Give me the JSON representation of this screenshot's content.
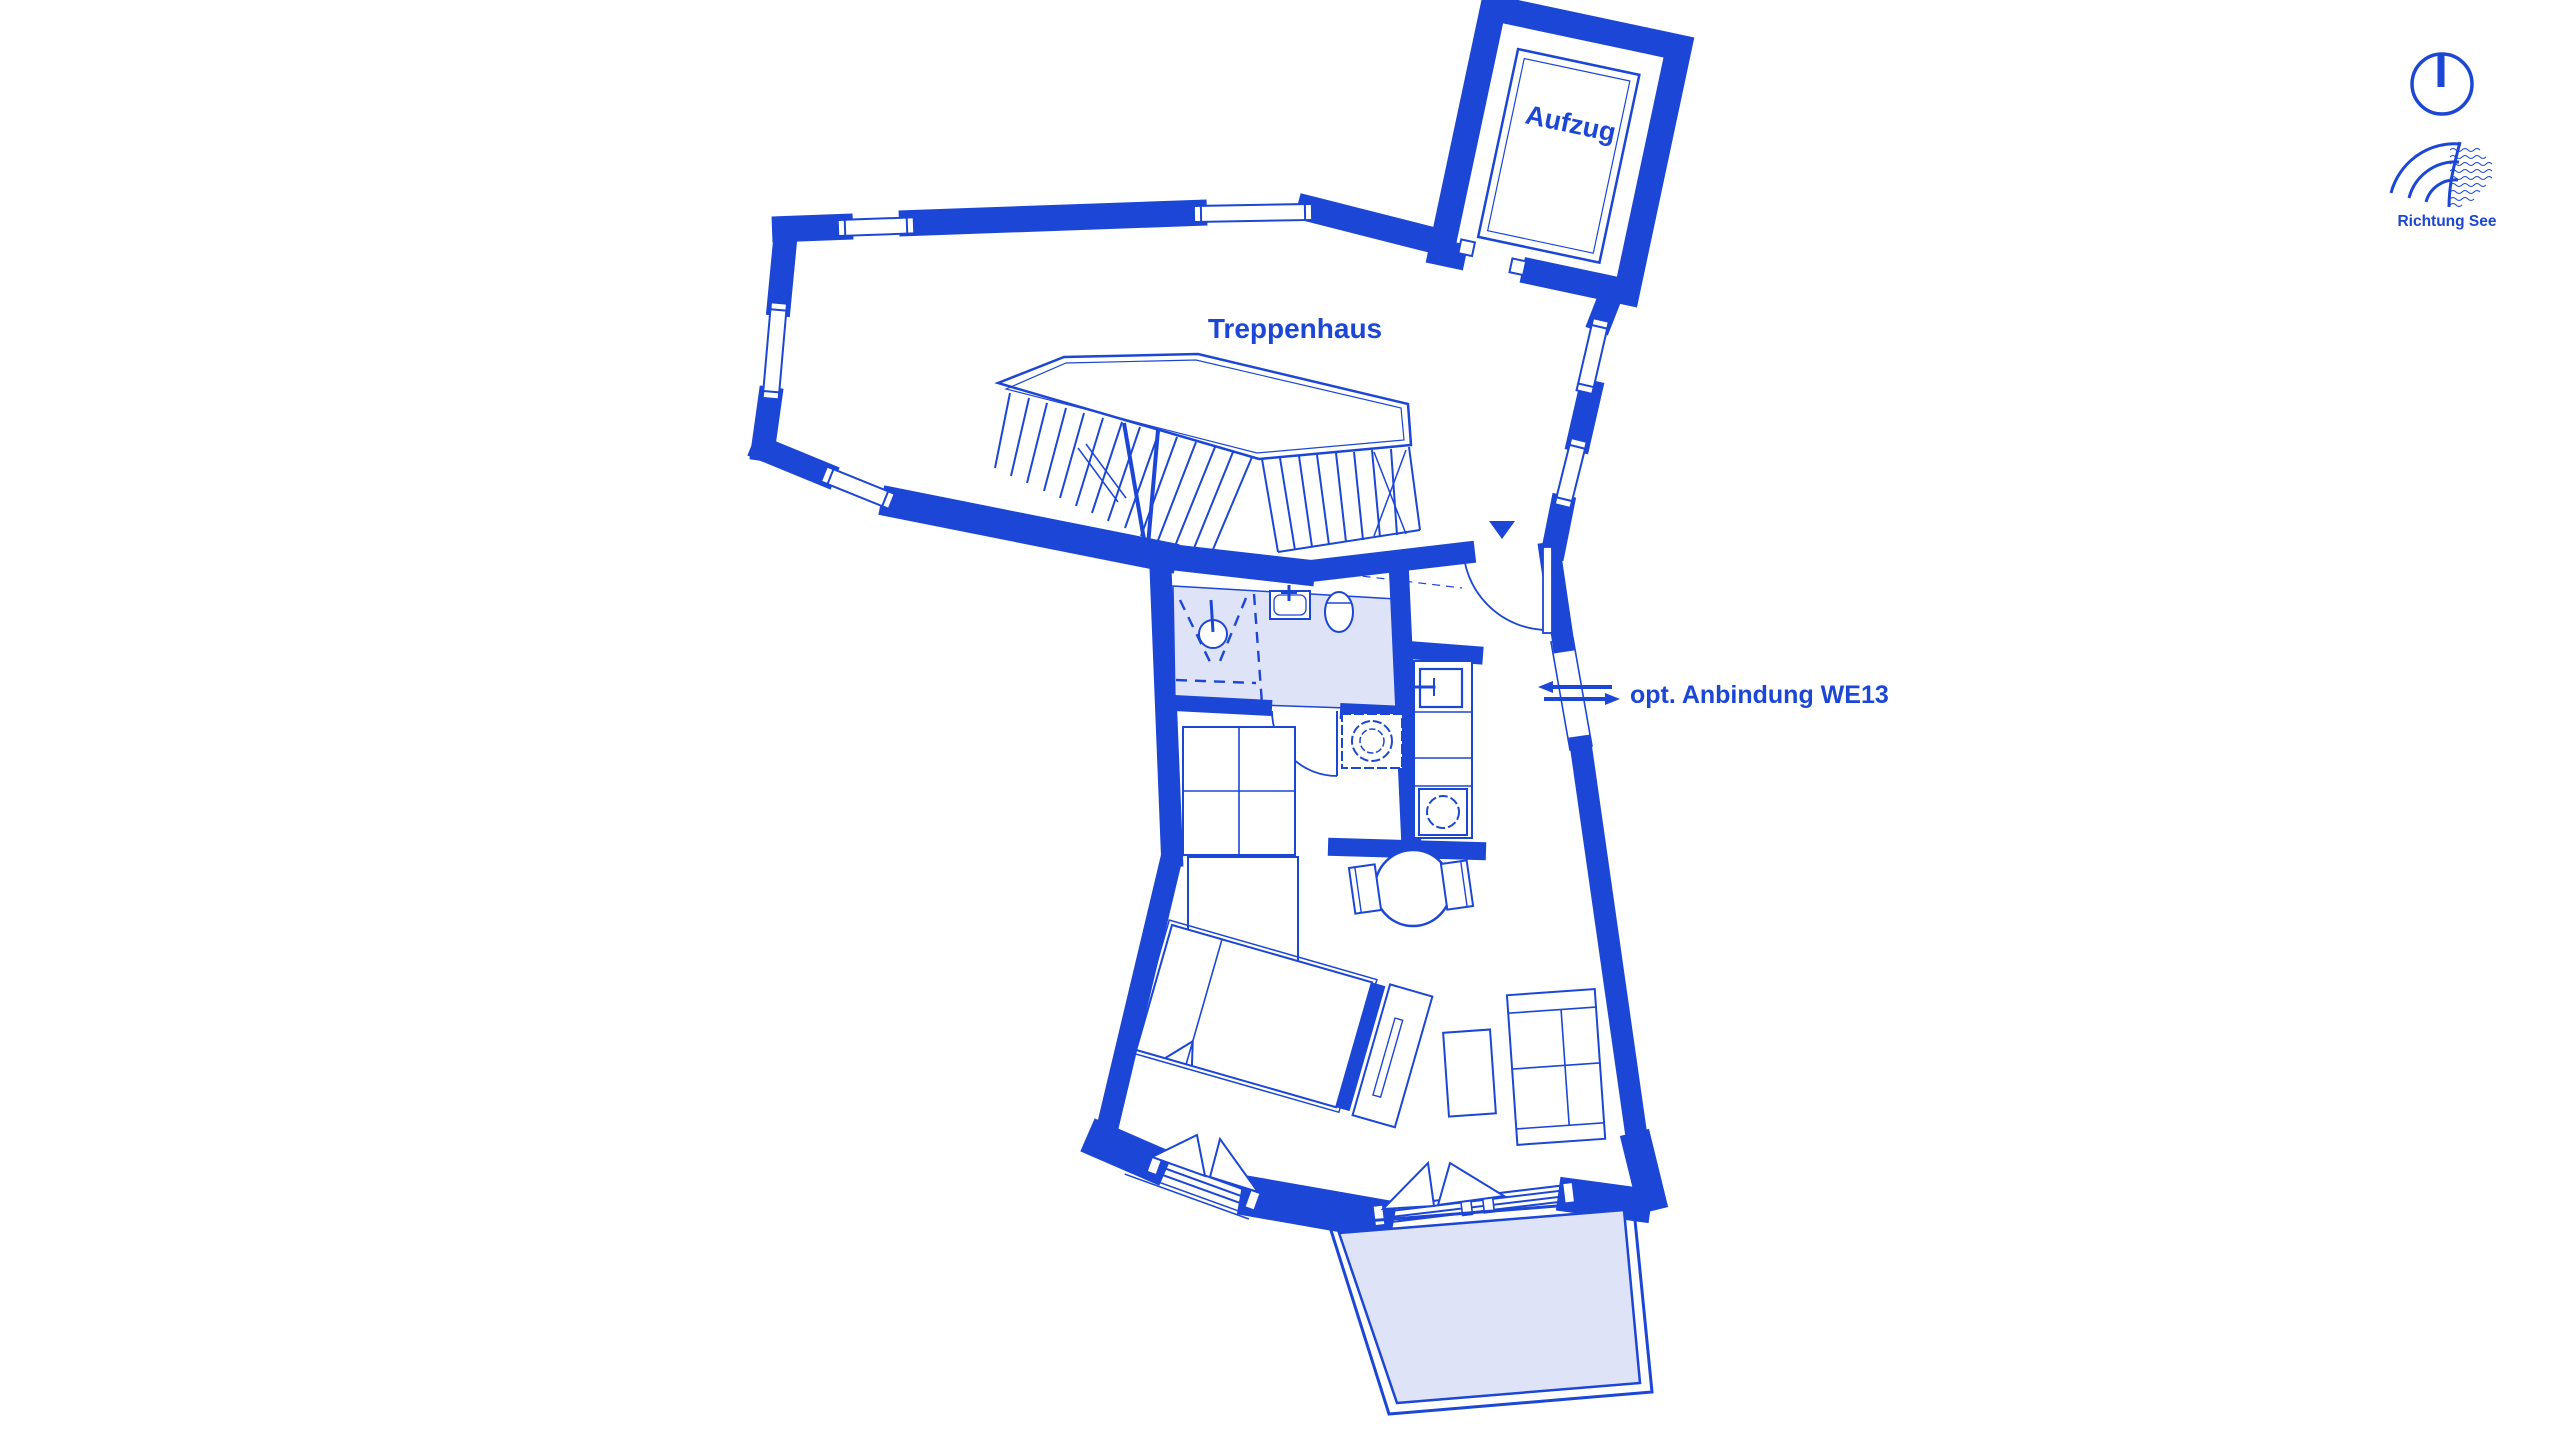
{
  "plan": {
    "labels": {
      "elevator": "Aufzug",
      "stairwell": "Treppenhaus",
      "connection": "opt. Anbindung WE13",
      "direction": "Richtung See"
    },
    "colors": {
      "line": "#1C46D6",
      "room_fill": "#DFE3F7",
      "background": "#FFFFFF"
    }
  }
}
